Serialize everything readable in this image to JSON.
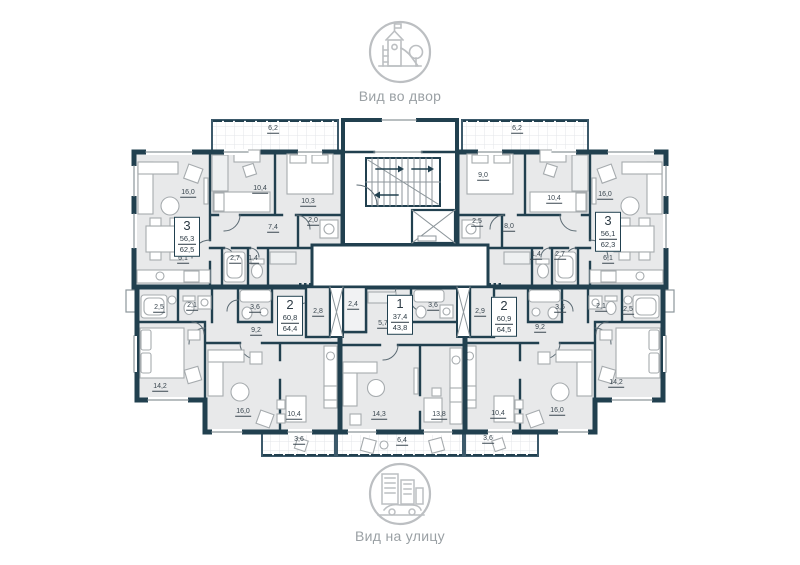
{
  "header": {
    "icon": "playground-icon",
    "caption": "Вид во двор"
  },
  "footer": {
    "icon": "city-street-icon",
    "caption": "Вид на улицу"
  },
  "plan": {
    "colors": {
      "wall": "#21404f",
      "floor": "#e8e9ea",
      "label": "#3a4750",
      "muted": "#9aa0a4",
      "icon": "#bcbfc2"
    },
    "apartments": [
      {
        "name": "top-left-3-room",
        "rooms": "3",
        "area_living": "56,3",
        "area_total": "62,5",
        "x": 187,
        "y": 237
      },
      {
        "name": "top-right-3-room",
        "rooms": "3",
        "area_living": "56,1",
        "area_total": "62,3",
        "x": 608,
        "y": 232
      },
      {
        "name": "bottom-left-2-room",
        "rooms": "2",
        "area_living": "60,8",
        "area_total": "64,4",
        "x": 290,
        "y": 316
      },
      {
        "name": "center-1-room",
        "rooms": "1",
        "area_living": "37,4",
        "area_total": "43,8",
        "x": 400,
        "y": 315
      },
      {
        "name": "bottom-right-2-room",
        "rooms": "2",
        "area_living": "60,9",
        "area_total": "64,5",
        "x": 504,
        "y": 317
      }
    ],
    "room_labels": [
      {
        "text": "6,2",
        "x": 273,
        "y": 130
      },
      {
        "text": "10,4",
        "x": 260,
        "y": 190
      },
      {
        "text": "10,3",
        "x": 308,
        "y": 203
      },
      {
        "text": "16,0",
        "x": 188,
        "y": 194
      },
      {
        "text": "7,4",
        "x": 273,
        "y": 229
      },
      {
        "text": "2,0",
        "x": 313,
        "y": 222
      },
      {
        "text": "2,7",
        "x": 235,
        "y": 260
      },
      {
        "text": "1,4",
        "x": 253,
        "y": 260
      },
      {
        "text": "6,1",
        "x": 183,
        "y": 260
      },
      {
        "text": "6,2",
        "x": 517,
        "y": 130
      },
      {
        "text": "9,0",
        "x": 483,
        "y": 177
      },
      {
        "text": "10,4",
        "x": 554,
        "y": 200
      },
      {
        "text": "16,0",
        "x": 605,
        "y": 196
      },
      {
        "text": "8,0",
        "x": 509,
        "y": 228
      },
      {
        "text": "2,5",
        "x": 477,
        "y": 223
      },
      {
        "text": "1,4",
        "x": 536,
        "y": 256
      },
      {
        "text": "2,7",
        "x": 560,
        "y": 256
      },
      {
        "text": "6,1",
        "x": 608,
        "y": 260
      },
      {
        "text": "2,5",
        "x": 159,
        "y": 309
      },
      {
        "text": "2,1",
        "x": 192,
        "y": 307
      },
      {
        "text": "3,6",
        "x": 255,
        "y": 309
      },
      {
        "text": "9,2",
        "x": 256,
        "y": 332
      },
      {
        "text": "2,8",
        "x": 318,
        "y": 313
      },
      {
        "text": "14,2",
        "x": 160,
        "y": 388
      },
      {
        "text": "16,0",
        "x": 243,
        "y": 413
      },
      {
        "text": "10,4",
        "x": 294,
        "y": 416
      },
      {
        "text": "3,6",
        "x": 299,
        "y": 441
      },
      {
        "text": "2,4",
        "x": 353,
        "y": 306
      },
      {
        "text": "5,7",
        "x": 383,
        "y": 325
      },
      {
        "text": "3,6",
        "x": 433,
        "y": 307
      },
      {
        "text": "14,3",
        "x": 379,
        "y": 416
      },
      {
        "text": "13,8",
        "x": 439,
        "y": 416
      },
      {
        "text": "6,4",
        "x": 402,
        "y": 442
      },
      {
        "text": "2,9",
        "x": 480,
        "y": 313
      },
      {
        "text": "9,2",
        "x": 540,
        "y": 329
      },
      {
        "text": "3,6",
        "x": 560,
        "y": 309
      },
      {
        "text": "2,1",
        "x": 601,
        "y": 308
      },
      {
        "text": "2,5",
        "x": 628,
        "y": 311
      },
      {
        "text": "14,2",
        "x": 616,
        "y": 384
      },
      {
        "text": "10,4",
        "x": 498,
        "y": 415
      },
      {
        "text": "16,0",
        "x": 557,
        "y": 412
      },
      {
        "text": "3,6",
        "x": 488,
        "y": 440
      }
    ]
  }
}
